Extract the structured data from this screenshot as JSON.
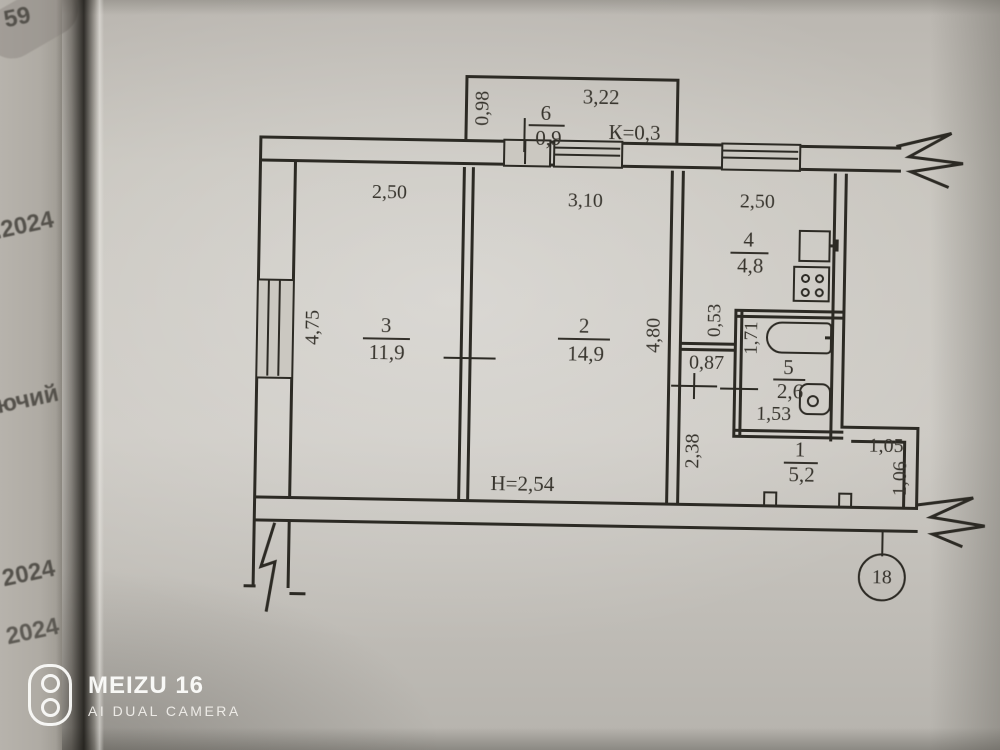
{
  "background_page": {
    "fragments": [
      "59",
      ".2024",
      "ючий",
      "2024",
      "2024"
    ]
  },
  "watermark": {
    "brand": "MEIZU 16",
    "subtitle": "AI DUAL CAMERA",
    "icon": "dual-camera-icon"
  },
  "plan": {
    "apartment_number": "18",
    "ceiling_height": "Н=2,54",
    "balcony": {
      "number": "6",
      "area": "0,9",
      "width": "3,22",
      "depth": "0,98",
      "coefficient": "К=0,3"
    },
    "rooms": [
      {
        "number": "3",
        "area": "11,9"
      },
      {
        "number": "2",
        "area": "14,9"
      },
      {
        "number": "4",
        "area": "4,8"
      },
      {
        "number": "5",
        "area": "2,6"
      },
      {
        "number": "1",
        "area": "5,2"
      }
    ],
    "dimensions": {
      "top_left": "2,50",
      "top_middle": "3,10",
      "top_right": "2,50",
      "left_side": "4,75",
      "middle": "4,80",
      "kitchen_recess": "0,53",
      "corridor": "0,87",
      "bath_depth": "1,71",
      "bath_width": "1,53",
      "hall_depth": "2,38",
      "entry_width": "1,05",
      "entry_depth": "1,06"
    }
  }
}
